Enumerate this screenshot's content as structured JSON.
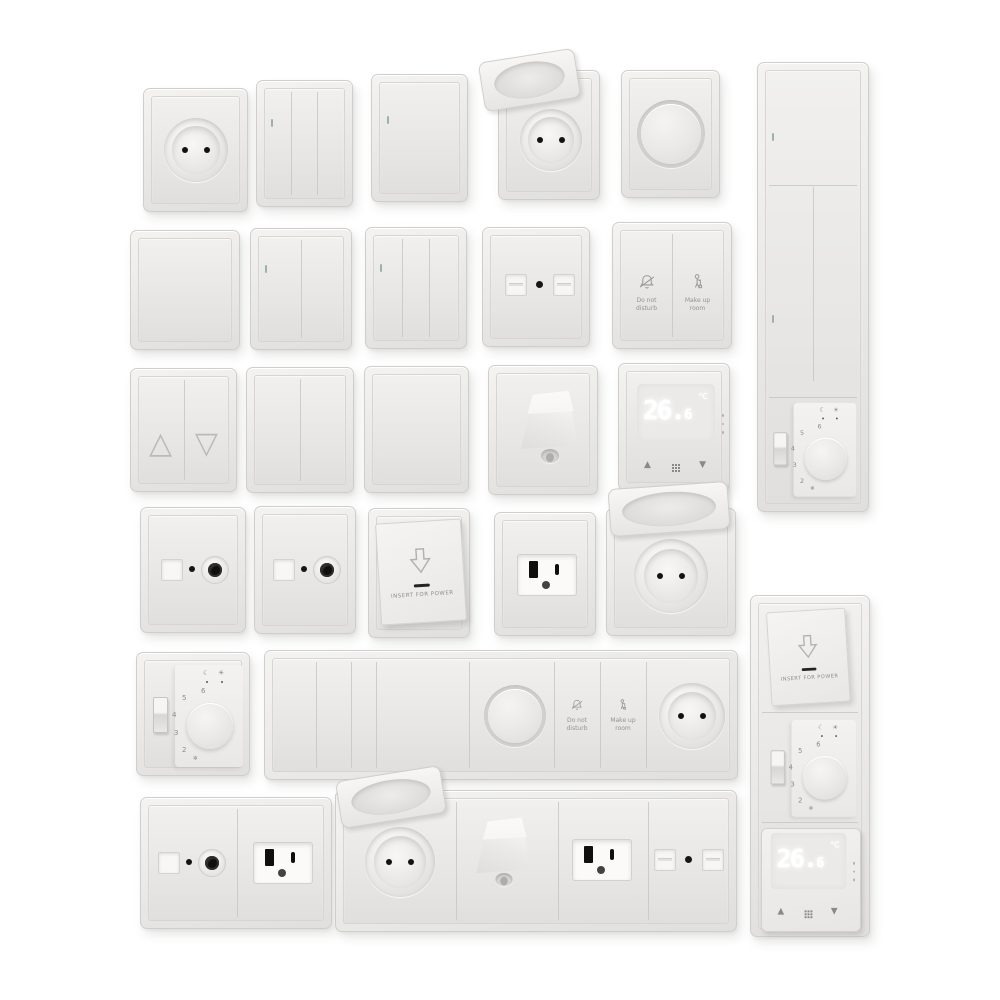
{
  "meta": {
    "description": "3D render catalog of white wall-mounted switches, sockets and thermostats on a white background",
    "background_color": "#ffffff",
    "plate_color": "#e9e8e6",
    "dark_contact_color": "#121210",
    "led_color": "#9db1ad"
  },
  "labels": {
    "do_not_1": "Do not",
    "do_not_2": "disturb",
    "make_up_1": "Make up",
    "make_up_2": "room",
    "insert_for_power": "INSERT FOR POWER"
  },
  "digital_thermostat": {
    "temp_main": "26.",
    "temp_minor": "6",
    "unit": "°C",
    "up_symbol": "▲",
    "down_symbol": "▼"
  },
  "dial_thermostat": {
    "scale": [
      "2",
      "3",
      "4",
      "5",
      "6"
    ],
    "moon_symbol": "☾",
    "sun_symbol": "☀",
    "frost_symbol": "❄"
  },
  "blinds": {
    "up_symbol": "△",
    "down_symbol": "▽"
  },
  "items": [
    "EU schuko socket",
    "3-gang rocker switch with indicator",
    "1-gang rocker switch with indicator",
    "EU schuko socket with open hinged lid",
    "rotary dimmer",
    "tall panel: large rocker, two vertical rockers, dial thermostat",
    "blank cover plate",
    "2-gang rocker switch with indicator",
    "3-gang rocker switch with indicator",
    "dual data socket",
    "hotel switch: do-not-disturb / make-up-room",
    "shutter switch with up/down triangles",
    "2-gang rocker switch",
    "1-gang rocker switch",
    "cable outlet with strain relief",
    "digital thermostat showing 26.6 °C",
    "TV coax socket",
    "TV coax socket",
    "key card power holder",
    "US type-B outlet",
    "EU schuko socket with open hinged lid",
    "dial thermostat with toggle",
    "horizontal strip: four rockers, dimmer, do-not-disturb, make-up-room, schuko socket",
    "tall strip: key card holder, dial thermostat, digital thermostat",
    "double plate: TV coax socket and US outlet",
    "horizontal strip: schuko with lid, cable outlet, US outlet, dual data socket"
  ]
}
